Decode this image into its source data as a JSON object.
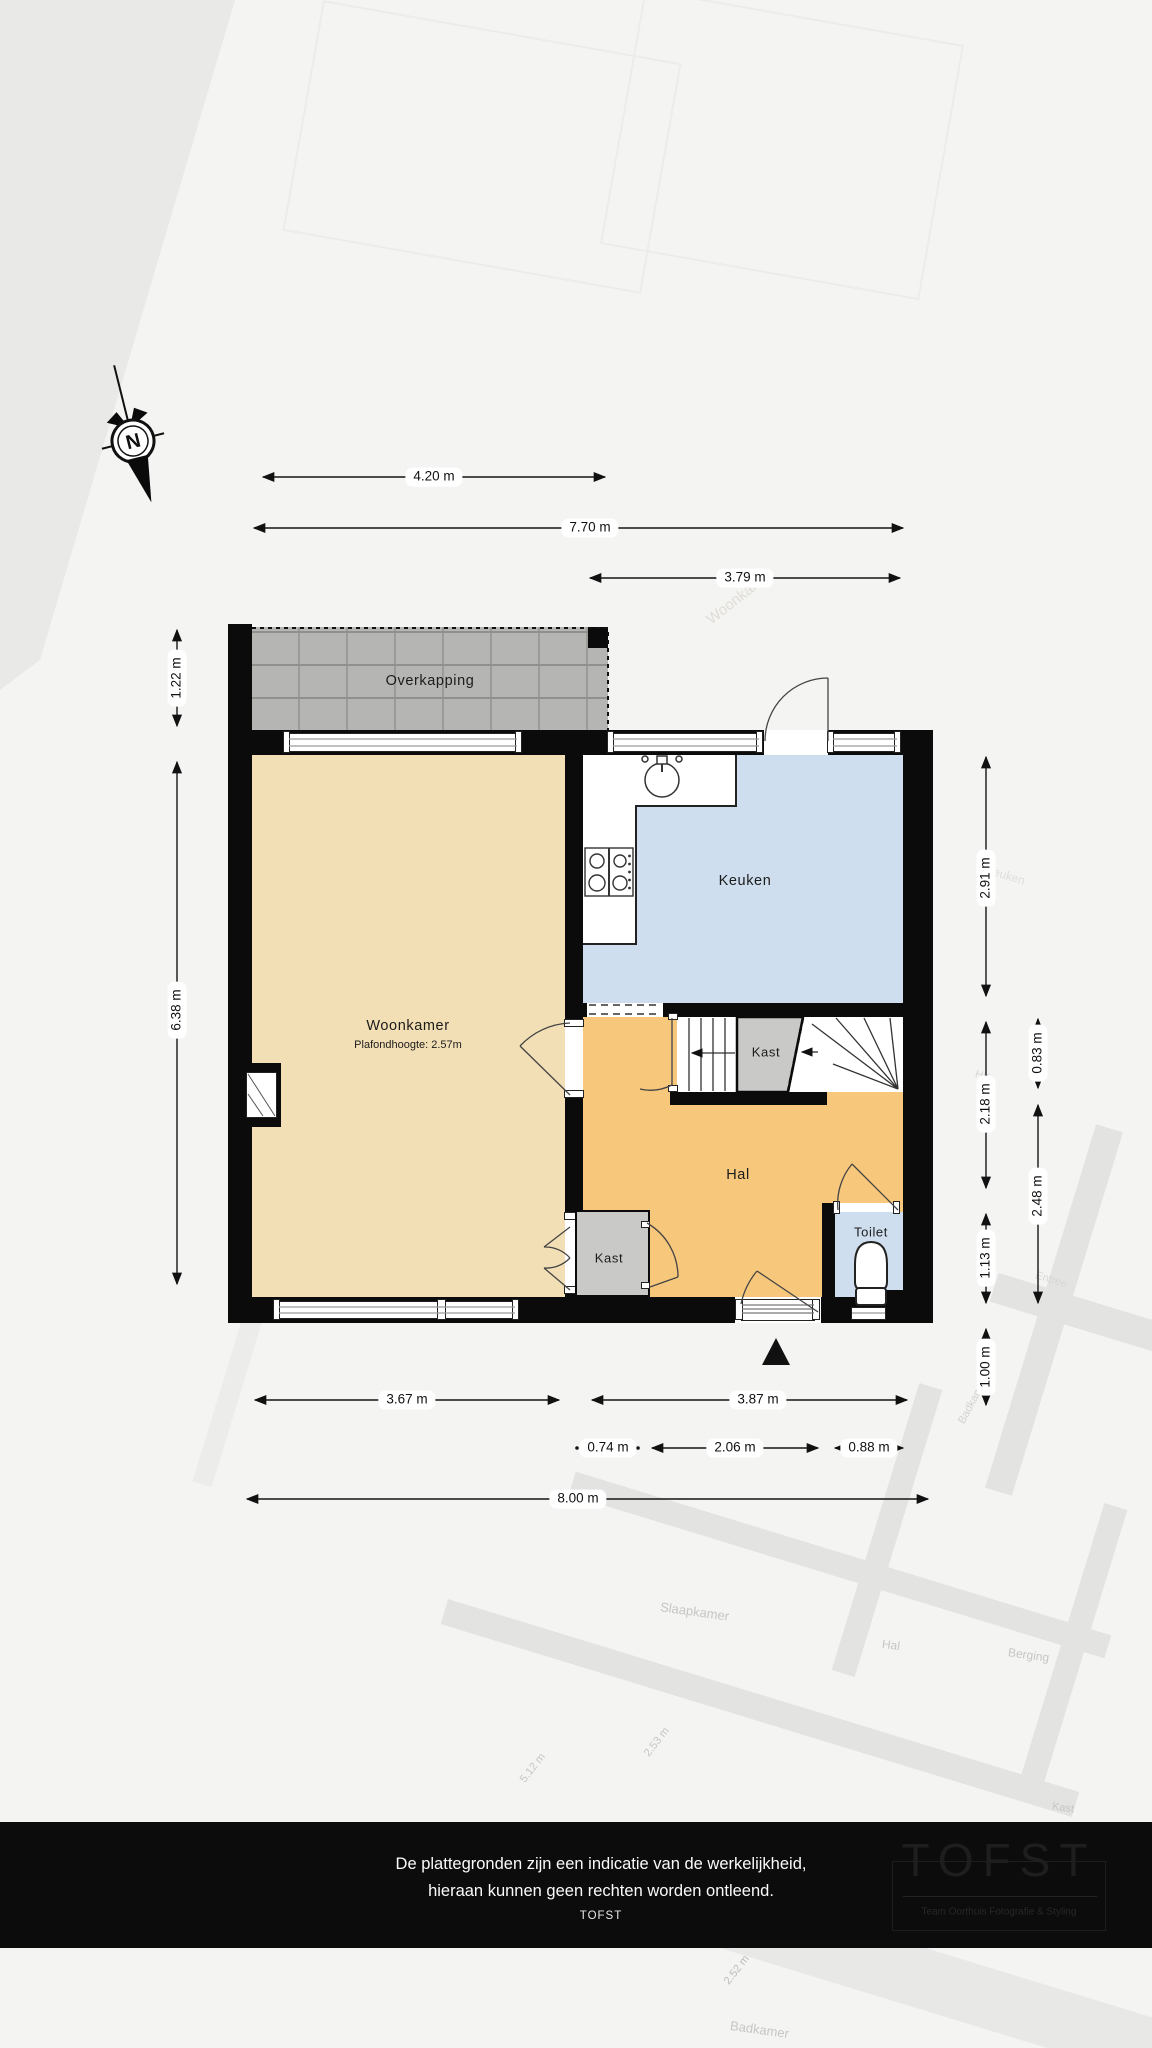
{
  "compass": {
    "label": "N"
  },
  "rooms": {
    "overkapping": "Overkapping",
    "woonkamer": {
      "name": "Woonkamer",
      "ceiling": "Plafondhoogte: 2.57m"
    },
    "keuken": "Keuken",
    "hal": "Hal",
    "kast_stairs": "Kast",
    "kast_hal": "Kast",
    "toilet": "Toilet"
  },
  "dimensions": {
    "top": [
      "4.20 m",
      "7.70 m",
      "3.79 m"
    ],
    "left": [
      "1.22 m",
      "6.38 m"
    ],
    "right": [
      "2.91 m",
      "2.18 m",
      "1.13 m",
      "1.00 m",
      "0.83 m",
      "2.48 m"
    ],
    "bottom": [
      "3.67 m",
      "3.87 m",
      "0.74 m",
      "2.06 m",
      "0.88 m",
      "8.00 m"
    ]
  },
  "watermark": {
    "labels": [
      "Woonkamer",
      "Keuken",
      "HK",
      "Entree",
      "Badkamer",
      "Slaapkamer",
      "Hal",
      "Berging",
      "Kast",
      "Badkamer",
      "2.53 m",
      "5.12 m",
      "2.52 m"
    ]
  },
  "footer": {
    "line1": "De plattegronden zijn een indicatie van de werkelijkheid,",
    "line2": "hieraan kunnen geen rechten worden ontleend.",
    "line3": "TOFST",
    "logo_title": "TOFST",
    "logo_subtitle": "Team Oorthuis Fotografie & Styling"
  },
  "colors": {
    "woonkamer": "#f2dfb5",
    "hal": "#f7c77c",
    "keuken": "#cfdeee",
    "toilet": "#cfdeee",
    "kast": "#c9c9c8",
    "wall": "#0b0b0b",
    "overkapping_tile": "#b5b6b3",
    "footer_bar": "#0c0c0c"
  }
}
